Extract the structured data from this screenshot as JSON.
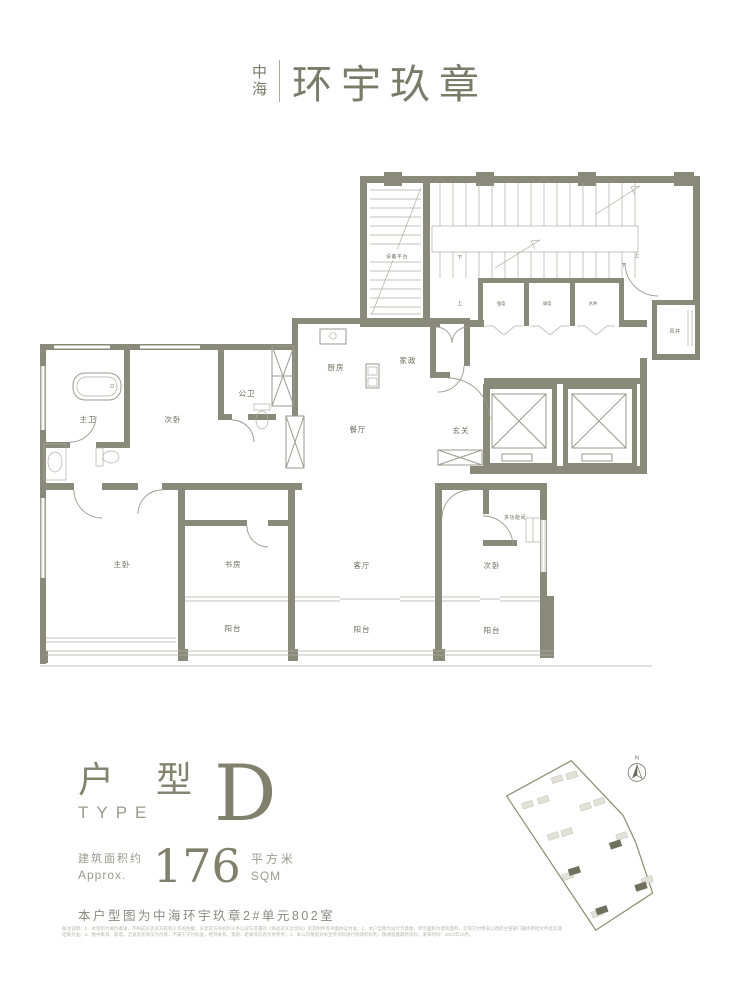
{
  "brand": {
    "logo_stack_top": "中",
    "logo_stack_bottom": "海",
    "logo_name": "环宇玖章"
  },
  "plan": {
    "labels": {
      "master_bath": "主卫",
      "bedroom_left": "次卧",
      "public_bath": "公卫",
      "kitchen": "厨房",
      "housekeeping": "家政",
      "dining": "餐厅",
      "foyer": "玄关",
      "master_bedroom": "主卧",
      "study": "书房",
      "living": "客厅",
      "bedroom_right": "次卧",
      "multi_room": "多功能间",
      "balcony_left": "阳台",
      "balcony_mid": "阳台",
      "balcony_right": "阳台",
      "equipment_platform": "设备平台",
      "strong_electric": "强电",
      "weak_electric": "弱电",
      "water_shaft": "水井",
      "air_shaft": "风井",
      "down_left": "下",
      "up_left": "上",
      "up_right": "上",
      "down_right": "下"
    }
  },
  "title_block": {
    "type_cn": "户 型",
    "type_en": "TYPE",
    "type_letter": "D",
    "area_label_cn": "建筑面积约",
    "area_label_en": "Approx.",
    "area_value": "176",
    "area_unit_cn": "平方米",
    "area_unit_en": "SQM",
    "unit_note": "本户型图为中海环宇玖章2#单元802室"
  },
  "site_map": {
    "north_label": "N"
  },
  "fine_print": "备注说明：1、本资料为要约邀请，不构成买卖双方权利义务的依据，买卖双方的权利义务以双方签署的《商品房买卖合同》及其附件等书面协议为准；2、本户型图为设计示意图，所示面积为建筑面积，实际交付情况以政府主管部门最终审批文件及实测结果为准；3、图中家具、家电、洁具及装饰仅为示意，不属于交付标准，相邻关系、景观、距离等信息仅供参考；4、本公司保留对本宣传资料进行修改的权利，敬请留意最新资料；发布时间：2023年10月。"
}
